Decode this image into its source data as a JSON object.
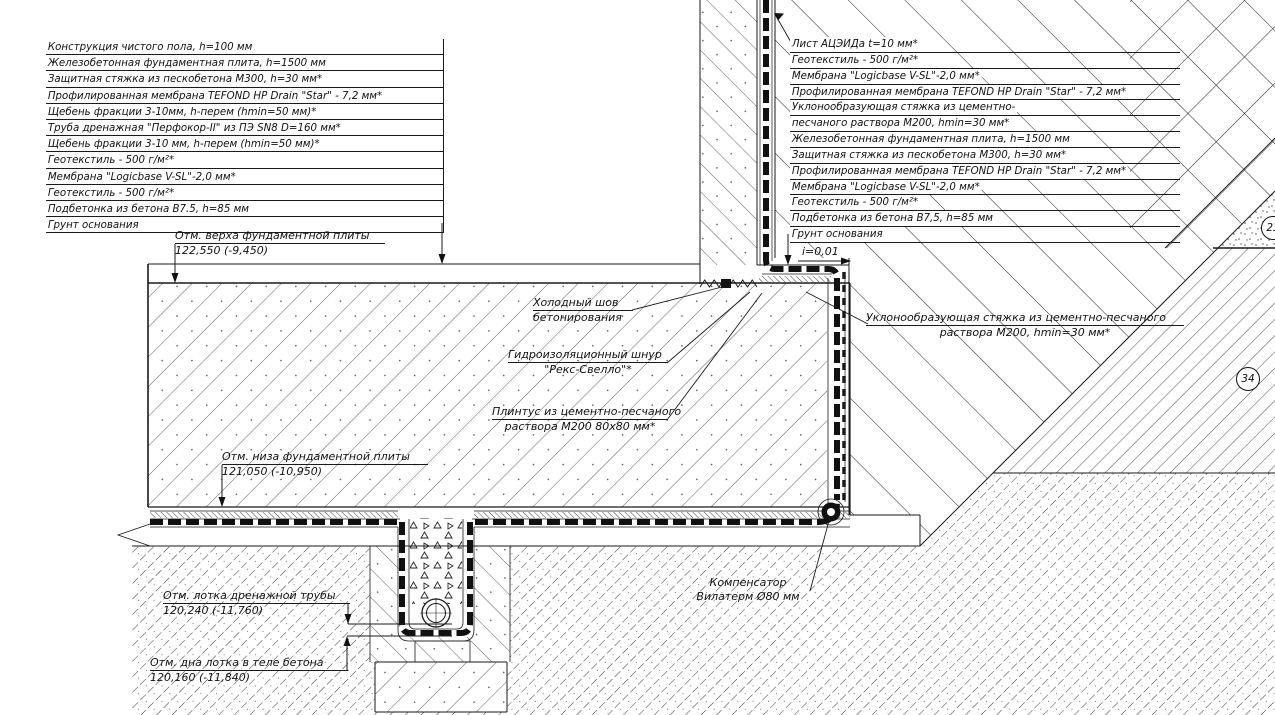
{
  "left_layers": {
    "items": [
      "Конструкция чистого пола, h=100 мм",
      "Железобетонная фундаментная плита, h=1500 мм",
      "Защитная стяжка из пескобетона М300, h=30 мм*",
      "Профилированная мембрана TEFOND HP Drain \"Star\" - 7,2 мм*",
      "Щебень фракции 3-10мм, h-перем (hmin=50 мм)*",
      "Труба дренажная \"Перфокор-II\" из ПЭ SN8 D=160 мм*",
      "Щебень фракции 3-10 мм, h-перем (hmin=50 мм)*",
      "Геотекстиль - 500 г/м²*",
      "Мембрана \"Logicbase V-SL\"-2,0 мм*",
      "Геотекстиль - 500 г/м²*",
      "Подбетонка из бетона В7.5, h=85 мм",
      "Грунт основания"
    ]
  },
  "right_layers": {
    "items": [
      "Лист АЦЭИДа t=10 мм*",
      "Геотекстиль - 500 г/м²*",
      "Мембрана \"Logicbase V-SL\"-2,0 мм*",
      "Профилированная мембрана TEFOND HP Drain \"Star\" - 7,2 мм*",
      "Уклонообразующая стяжка из цементно-",
      "песчаного раствора М200, hmin=30 мм*",
      "Железобетонная фундаментная плита, h=1500 мм",
      "Защитная стяжка из пескобетона М300, h=30 мм*",
      "Профилированная мембрана TEFOND HP Drain \"Star\" - 7,2 мм*",
      "Мембрана \"Logicbase V-SL\"-2,0 мм*",
      "Геотекстиль - 500 г/м²*",
      "Подбетонка из бетона В7,5, h=85 мм",
      "Грунт основания"
    ]
  },
  "elevations": {
    "slab_top": {
      "label": "Отм. верха фундаментной плиты",
      "value": "122,550 (-9,450)"
    },
    "slab_bottom": {
      "label": "Отм. низа фундаментной плиты",
      "value": "121,050 (-10,950)"
    },
    "pipe_invert": {
      "label": "Отм. лотка дренажной трубы",
      "value": "120,240 (-11,760)"
    },
    "tray_bottom": {
      "label": "Отм. дна лотка в теле бетона",
      "value": "120,160 (-11,840)"
    }
  },
  "callouts": {
    "cold_joint": {
      "line1": "Холодный шов",
      "line2": "бетонирования"
    },
    "waterstop": {
      "line1": "Гидроизоляционный шнур",
      "line2": "\"Рекс-Свелло\"*"
    },
    "plinth": {
      "line1": "Плинтус из цементно-песчаного",
      "line2": "раствора М200 80х80 мм*"
    },
    "slope_screed": {
      "line1": "Уклонообразующая стяжка из цементно-песчаного",
      "line2": "раствора М200, hmin=30 мм*"
    },
    "compensator": {
      "line1": "Компенсатор",
      "line2": "Вилатерм Ø80 мм"
    },
    "slope": "i=0,01"
  },
  "markers": {
    "m23": "23",
    "m34": "34"
  },
  "colors": {
    "line": "#1a1a1a",
    "background": "#ffffff"
  }
}
